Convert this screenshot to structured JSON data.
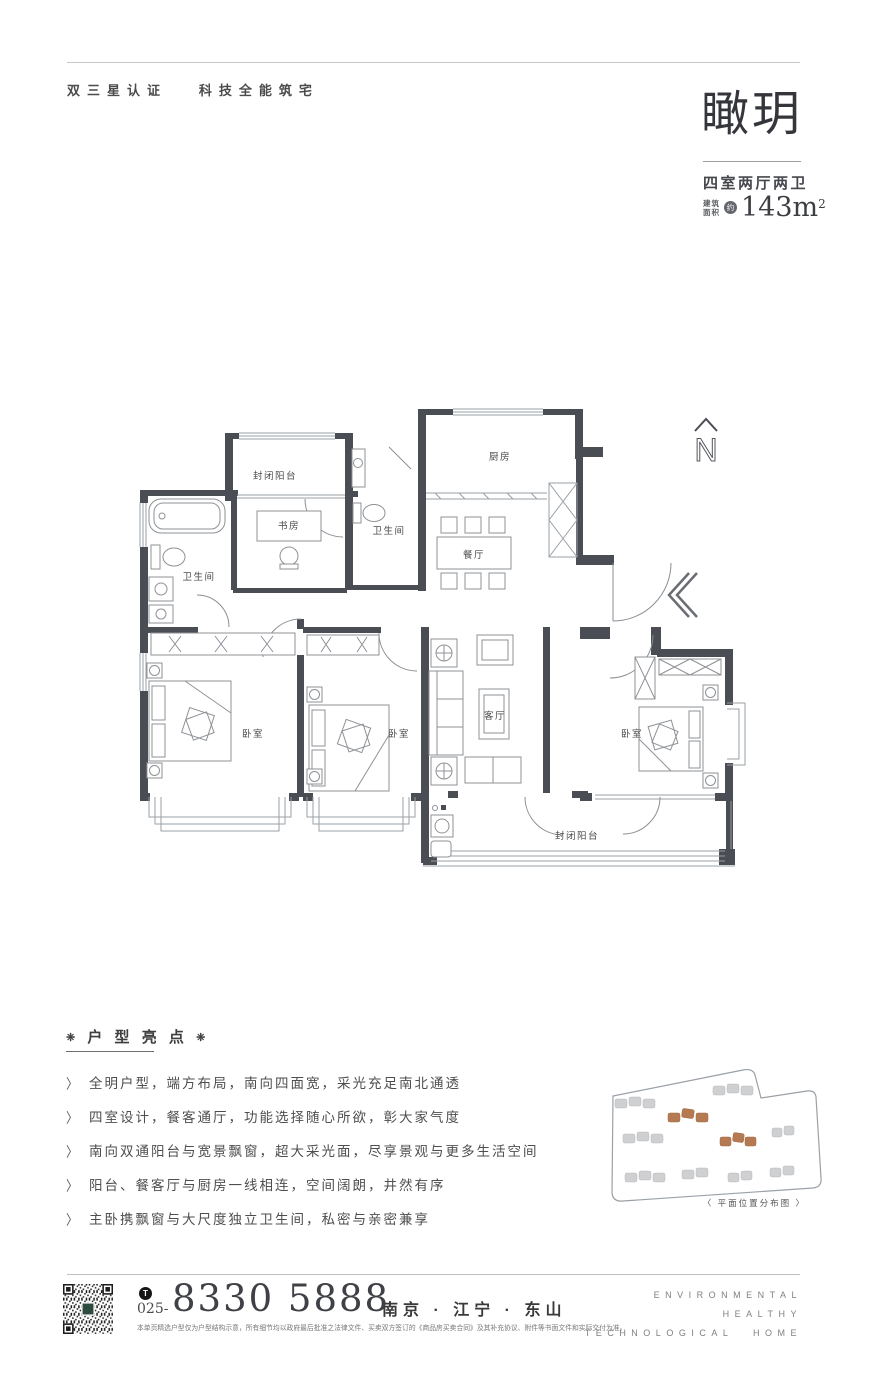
{
  "header": {
    "tagline": "双三星认证   科技全能筑宅",
    "title": "瞰玥",
    "layout_type": "四室两厅两卫",
    "area_label_top": "建筑",
    "area_label_bottom": "面积",
    "area_approx_mark": "约",
    "area_value": "143m",
    "area_superscript": "2"
  },
  "floorplan": {
    "compass_label": "N",
    "rooms": [
      {
        "id": "balcony-top",
        "label": "封闭阳台"
      },
      {
        "id": "study",
        "label": "书房"
      },
      {
        "id": "bathroom-left",
        "label": "卫生间"
      },
      {
        "id": "bathroom-middle",
        "label": "卫生间"
      },
      {
        "id": "kitchen",
        "label": "厨房"
      },
      {
        "id": "dining",
        "label": "餐厅"
      },
      {
        "id": "bedroom-left",
        "label": "卧室"
      },
      {
        "id": "bedroom-middle",
        "label": "卧室"
      },
      {
        "id": "living-room",
        "label": "客厅"
      },
      {
        "id": "bedroom-right",
        "label": "卧室"
      },
      {
        "id": "balcony-bottom",
        "label": "封闭阳台"
      }
    ]
  },
  "highlights": {
    "ornament": "❈",
    "title": "户 型 亮 点",
    "bullet": "〉",
    "items": [
      "全明户型，端方布局，南向四面宽，采光充足南北通透",
      "四室设计，餐客通厅，功能选择随心所欲，彰大家气度",
      "南向双通阳台与宽景飘窗，超大采光面，尽享景观与更多生活空间",
      "阳台、餐客厅与厨房一线相连，空间阔朗，井然有序",
      "主卧携飘窗与大尺度独立卫生间，私密与亲密兼享"
    ]
  },
  "siteplan": {
    "caption": "〈 平面位置分布图 〉"
  },
  "footer": {
    "phone_icon_letter": "T",
    "phone_prefix": "025-",
    "phone_number": "8330 5888",
    "location": "南京 · 江宁 · 东山",
    "disclaimer": "本单页精选户型仅为户型结构示意，所有细节均以政府最后批准之法律文件、买卖双方签订的《商品房买卖合同》及其补充协议、附件等书面文件和实际交付为准。",
    "slogan_line1": "ENVIRONMENTAL",
    "slogan_line2": "HEALTHY",
    "slogan_line3": "TECHNOLOGICAL HOME"
  },
  "colors": {
    "wall": "#4a4d53",
    "thin_line": "#9aa0a6",
    "highlight_building": "#b57a52",
    "qr_logo_green": "#2e4b3f"
  }
}
